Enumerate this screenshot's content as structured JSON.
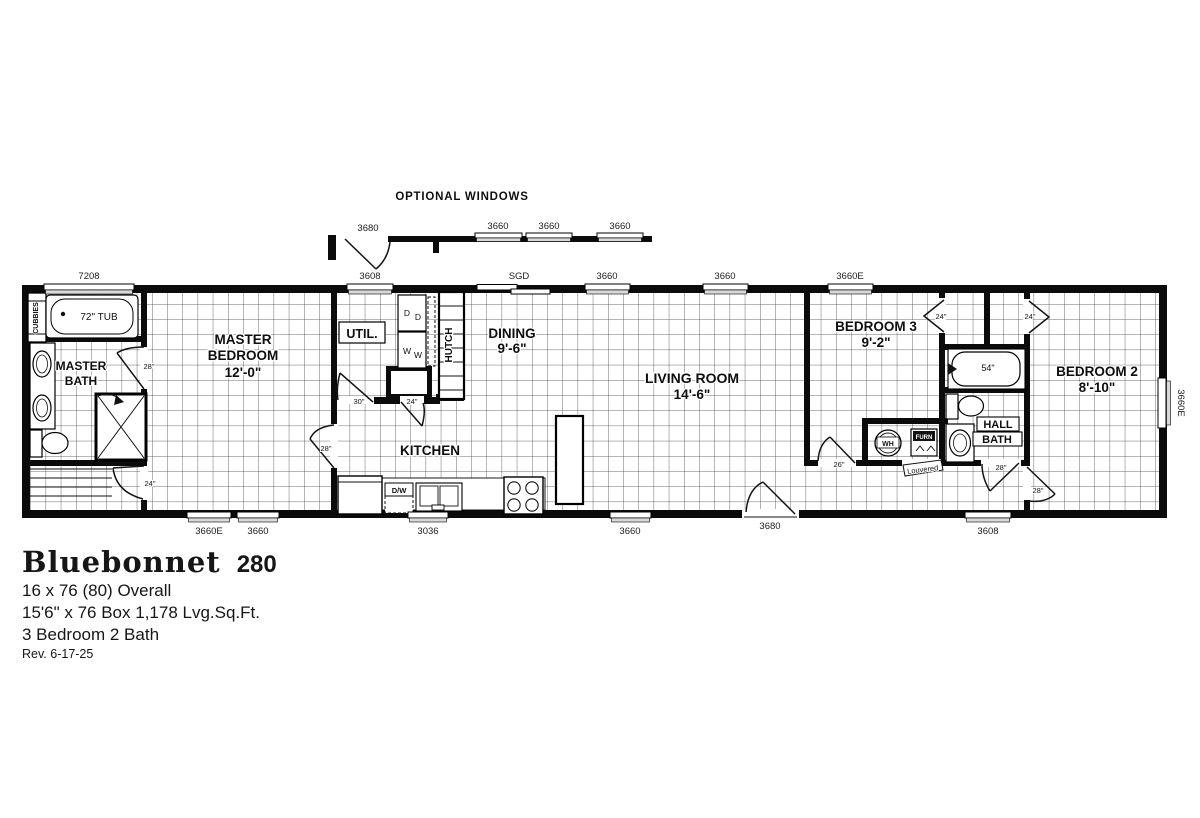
{
  "colors": {
    "ink": "#000000",
    "grid_line": "#3a3a3a",
    "paper": "#ffffff",
    "window_fill": "#d9d9d9"
  },
  "title_block": {
    "model": "Bluebonnet",
    "series": "280",
    "spec_overall": "16 x 76 (80) Overall",
    "spec_box": "15'6\" x 76 Box  1,178 Lvg.Sq.Ft.",
    "spec_rooms": "3 Bedroom  2 Bath",
    "revision": "Rev. 6-17-25"
  },
  "optional_windows": {
    "heading": "OPTIONAL WINDOWS",
    "door_label": "3680",
    "window_labels": [
      "3660",
      "3660",
      "3660"
    ]
  },
  "windows": {
    "top": [
      "7208",
      "3608",
      "SGD",
      "3660",
      "3660",
      "3660E"
    ],
    "bottom": [
      "3660E",
      "3660",
      "3036",
      "3660",
      "3680",
      "3608"
    ],
    "right": [
      "3660E"
    ]
  },
  "rooms": {
    "master_bath": {
      "line1": "MASTER",
      "line2": "BATH"
    },
    "master_bedroom": {
      "line1": "MASTER",
      "line2": "BEDROOM",
      "dim": "12'-0\""
    },
    "utility": {
      "name": "UTIL."
    },
    "dining": {
      "name": "DINING",
      "dim": "9'-6\""
    },
    "kitchen": {
      "name": "KITCHEN"
    },
    "living_room": {
      "name": "LIVING ROOM",
      "dim": "14'-6\""
    },
    "bedroom3": {
      "name": "BEDROOM 3",
      "dim": "9'-2\""
    },
    "hall_bath": {
      "line1": "HALL",
      "line2": "BATH"
    },
    "bedroom2": {
      "name": "BEDROOM 2",
      "dim": "8'-10\""
    }
  },
  "doors": {
    "master_bath": "28\"",
    "master_closet": "24\"",
    "master_bedroom": "28\"",
    "utility": "30\"",
    "pantry": "24\"",
    "bedroom3": "26\"",
    "bedroom3_closet": "24\"",
    "bedroom2_closet": "24\"",
    "hall_bath": "28\"",
    "bedroom2": "28\"",
    "louvered": "Louvered"
  },
  "fixtures": {
    "cubbies": "CUBBIES",
    "master_tub": "72\" TUB",
    "hall_tub": "54\"",
    "dishwasher": "D/W",
    "water_heater": "WH",
    "furnace": "FURN",
    "washer": "W",
    "dryer": "D",
    "hutch": "HUTCH"
  }
}
